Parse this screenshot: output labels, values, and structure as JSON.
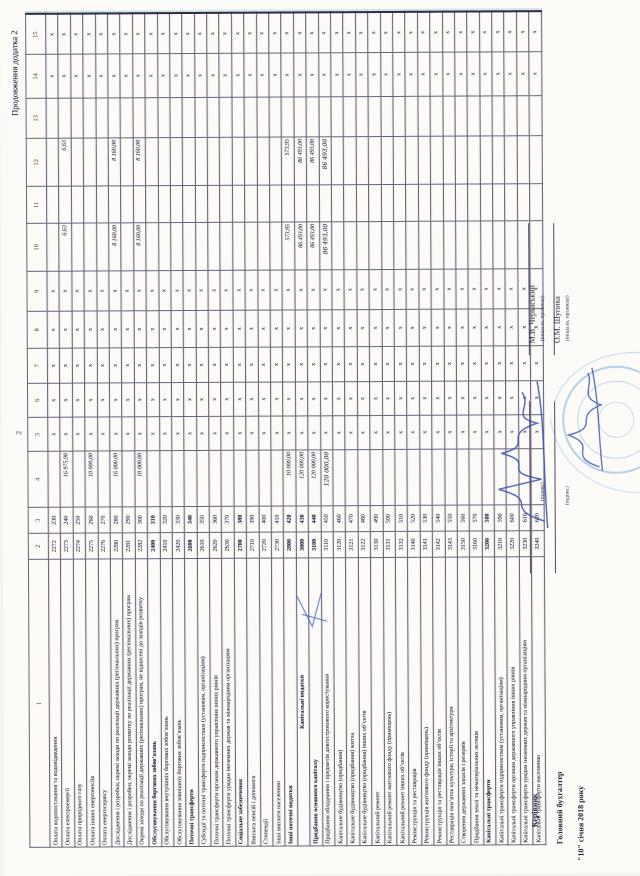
{
  "page": {
    "appendix_note": "Продовження додатка 2",
    "page_number": "2"
  },
  "table": {
    "column_numbers": [
      "1",
      "2",
      "3",
      "4",
      "5",
      "6",
      "7",
      "8",
      "9",
      "10",
      "11",
      "12",
      "13",
      "14",
      "15"
    ],
    "x_mark": "х",
    "x_columns": [
      5,
      6,
      7,
      8,
      9,
      14,
      15
    ],
    "rows": [
      {
        "name": "Оплата водопостачання та водовідведення",
        "kekv": "2272",
        "code": "230",
        "col4": "",
        "col10": "",
        "col12": "",
        "bold": false,
        "handwritten": false,
        "center": false
      },
      {
        "name": "Оплата електроенергії",
        "kekv": "2273",
        "code": "240",
        "col4": "16 975,98",
        "col10": "6,63",
        "col12": "6,63",
        "bold": false,
        "handwritten": false,
        "center": false
      },
      {
        "name": "Оплата природного газу",
        "kekv": "2274",
        "code": "250",
        "col4": "",
        "col10": "",
        "col12": "",
        "bold": false,
        "handwritten": false,
        "center": false
      },
      {
        "name": "Оплата інших енергоносіїв",
        "kekv": "2275",
        "code": "260",
        "col4": "10 000,00",
        "col10": "",
        "col12": "",
        "bold": false,
        "handwritten": false,
        "center": false
      },
      {
        "name": "Оплата енергосервісу",
        "kekv": "2276",
        "code": "270",
        "col4": "",
        "col10": "",
        "col12": "",
        "bold": false,
        "handwritten": false,
        "center": false
      },
      {
        "name": "Дослідження і розробки, окремі заходи по реалізації державних (регіональних) програм",
        "kekv": "2280",
        "code": "280",
        "col4": "16 000,00",
        "col10": "8 160,00",
        "col12": "8 160,00",
        "bold": false,
        "handwritten": false,
        "center": false
      },
      {
        "name": "Дослідження і розробки, окремі заходи розвитку по реалізації державних (регіональних) програм",
        "kekv": "2281",
        "code": "290",
        "col4": "",
        "col10": "",
        "col12": "",
        "bold": false,
        "handwritten": false,
        "center": false
      },
      {
        "name": "Окремі заходи по реалізації державних (регіональних) програм, не віднесені до заходів розвитку",
        "kekv": "2282",
        "code": "300",
        "col4": "10 000,00",
        "col10": "8 160,00",
        "col12": "8 160,00",
        "bold": false,
        "handwritten": false,
        "center": false
      },
      {
        "name": "Обслуговування боргових зобов’язань",
        "kekv": "2400",
        "code": "310",
        "col4": "",
        "col10": "",
        "col12": "",
        "bold": true,
        "handwritten": false,
        "center": false
      },
      {
        "name": "Обслуговування внутрішніх боргових зобов’язань",
        "kekv": "2410",
        "code": "320",
        "col4": "",
        "col10": "",
        "col12": "",
        "bold": false,
        "handwritten": false,
        "center": false
      },
      {
        "name": "Обслуговування зовнішніх боргових зобов’язань",
        "kekv": "2420",
        "code": "330",
        "col4": "",
        "col10": "",
        "col12": "",
        "bold": false,
        "handwritten": false,
        "center": false
      },
      {
        "name": "Поточні трансферти",
        "kekv": "2600",
        "code": "340",
        "col4": "",
        "col10": "",
        "col12": "",
        "bold": true,
        "handwritten": false,
        "center": false
      },
      {
        "name": "Субсидії та поточні трансферти підприємствам (установам, організаціям)",
        "kekv": "2610",
        "code": "350",
        "col4": "",
        "col10": "",
        "col12": "",
        "bold": false,
        "handwritten": false,
        "center": false
      },
      {
        "name": "Поточні трансферти органам державного управління інших рівнів",
        "kekv": "2620",
        "code": "360",
        "col4": "",
        "col10": "",
        "col12": "",
        "bold": false,
        "handwritten": false,
        "center": false
      },
      {
        "name": "Поточні трансферти урядам іноземних держав та міжнародним організаціям",
        "kekv": "2630",
        "code": "370",
        "col4": "",
        "col10": "",
        "col12": "",
        "bold": false,
        "handwritten": false,
        "center": false
      },
      {
        "name": "Соціальне забезпечення",
        "kekv": "2700",
        "code": "380",
        "col4": "",
        "col10": "",
        "col12": "",
        "bold": true,
        "handwritten": false,
        "center": false
      },
      {
        "name": "Виплата пенсій і допомоги",
        "kekv": "2710",
        "code": "390",
        "col4": "",
        "col10": "",
        "col12": "",
        "bold": false,
        "handwritten": false,
        "center": false
      },
      {
        "name": "Стипендії",
        "kekv": "2720",
        "code": "400",
        "col4": "",
        "col10": "",
        "col12": "",
        "bold": false,
        "handwritten": false,
        "center": false
      },
      {
        "name": "Інші виплати населенню",
        "kekv": "2730",
        "code": "410",
        "col4": "",
        "col10": "",
        "col12": "",
        "bold": false,
        "handwritten": false,
        "center": false
      },
      {
        "name": "Інші поточні видатки",
        "kekv": "2800",
        "code": "420",
        "col4": "10 000,00",
        "col10": "573,95",
        "col12": "573,95",
        "bold": true,
        "handwritten": false,
        "center": false
      },
      {
        "name": "Капітальні видатки",
        "kekv": "3000",
        "code": "430",
        "col4": "120 000,00",
        "col10": "86 493,00",
        "col12": "86 493,00",
        "bold": true,
        "handwritten": false,
        "center": true
      },
      {
        "name": "Придбання основного капіталу",
        "kekv": "3100",
        "code": "440",
        "col4": "120 000,00",
        "col10": "86 493,00",
        "col12": "86 493,00",
        "bold": true,
        "handwritten": false,
        "center": false
      },
      {
        "name": "Придбання обладнання і предметів довгострокового користування",
        "kekv": "3110",
        "code": "450",
        "col4": "120 000,00",
        "col10": "86 493,00",
        "col12": "86 493,00",
        "bold": false,
        "handwritten": true,
        "center": false
      },
      {
        "name": "Капітальне будівництво (придбання)",
        "kekv": "3120",
        "code": "460",
        "col4": "",
        "col10": "",
        "col12": "",
        "bold": false,
        "handwritten": false,
        "center": false
      },
      {
        "name": "Капітальне будівництво (придбання) житла",
        "kekv": "3121",
        "code": "470",
        "col4": "",
        "col10": "",
        "col12": "",
        "bold": false,
        "handwritten": false,
        "center": false
      },
      {
        "name": "Капітальне будівництво (придбання) інших об’єктів",
        "kekv": "3122",
        "code": "480",
        "col4": "",
        "col10": "",
        "col12": "",
        "bold": false,
        "handwritten": false,
        "center": false
      },
      {
        "name": "Капітальний ремонт",
        "kekv": "3130",
        "code": "490",
        "col4": "",
        "col10": "",
        "col12": "",
        "bold": false,
        "handwritten": false,
        "center": false
      },
      {
        "name": "Капітальний ремонт житлового фонду (приміщень)",
        "kekv": "3131",
        "code": "500",
        "col4": "",
        "col10": "",
        "col12": "",
        "bold": false,
        "handwritten": false,
        "center": false
      },
      {
        "name": "Капітальний ремонт інших об’єктів",
        "kekv": "3132",
        "code": "510",
        "col4": "",
        "col10": "",
        "col12": "",
        "bold": false,
        "handwritten": false,
        "center": false
      },
      {
        "name": "Реконструкція та реставрація",
        "kekv": "3140",
        "code": "520",
        "col4": "",
        "col10": "",
        "col12": "",
        "bold": false,
        "handwritten": false,
        "center": false
      },
      {
        "name": "Реконструкція житлового фонду (приміщень)",
        "kekv": "3141",
        "code": "530",
        "col4": "",
        "col10": "",
        "col12": "",
        "bold": false,
        "handwritten": false,
        "center": false
      },
      {
        "name": "Реконструкція та реставрація інших об’єктів",
        "kekv": "3142",
        "code": "540",
        "col4": "",
        "col10": "",
        "col12": "",
        "bold": false,
        "handwritten": false,
        "center": false
      },
      {
        "name": "Реставрація пам’яток культури, історії та архітектури",
        "kekv": "3143",
        "code": "550",
        "col4": "",
        "col10": "",
        "col12": "",
        "bold": false,
        "handwritten": false,
        "center": false
      },
      {
        "name": "Створення державних запасів і резервів",
        "kekv": "3150",
        "code": "560",
        "col4": "",
        "col10": "",
        "col12": "",
        "bold": false,
        "handwritten": false,
        "center": false
      },
      {
        "name": "Придбання землі та нематеріальних активів",
        "kekv": "3160",
        "code": "570",
        "col4": "",
        "col10": "",
        "col12": "",
        "bold": false,
        "handwritten": false,
        "center": false
      },
      {
        "name": "Капітальні трансферти",
        "kekv": "3200",
        "code": "580",
        "col4": "",
        "col10": "",
        "col12": "",
        "bold": true,
        "handwritten": false,
        "center": false
      },
      {
        "name": "Капітальні трансферти підприємствам (установам, організаціям)",
        "kekv": "3210",
        "code": "590",
        "col4": "",
        "col10": "",
        "col12": "",
        "bold": false,
        "handwritten": false,
        "center": false
      },
      {
        "name": "Капітальні трансферти органам державного управління інших рівнів",
        "kekv": "3220",
        "code": "600",
        "col4": "",
        "col10": "",
        "col12": "",
        "bold": false,
        "handwritten": false,
        "center": false
      },
      {
        "name": "Капітальні трансферти урядам іноземних держав та міжнародним організаціям",
        "kekv": "3230",
        "code": "610",
        "col4": "",
        "col10": "",
        "col12": "",
        "bold": false,
        "handwritten": false,
        "center": false
      },
      {
        "name": "Капітальні трансферти населенню",
        "kekv": "3240",
        "code": "620",
        "col4": "",
        "col10": "",
        "col12": "",
        "bold": false,
        "handwritten": false,
        "center": false
      }
    ]
  },
  "signatures": {
    "head_label": "Керівник",
    "head_name": "М.В. Черкаський",
    "accountant_label": "Головний бухгалтер",
    "accountant_name": "О.М. Шупика",
    "date_line": "\"10\" січня 2018 року",
    "sign_caption": "(підпис)",
    "name_caption": "(ініціали, прізвище)"
  }
}
